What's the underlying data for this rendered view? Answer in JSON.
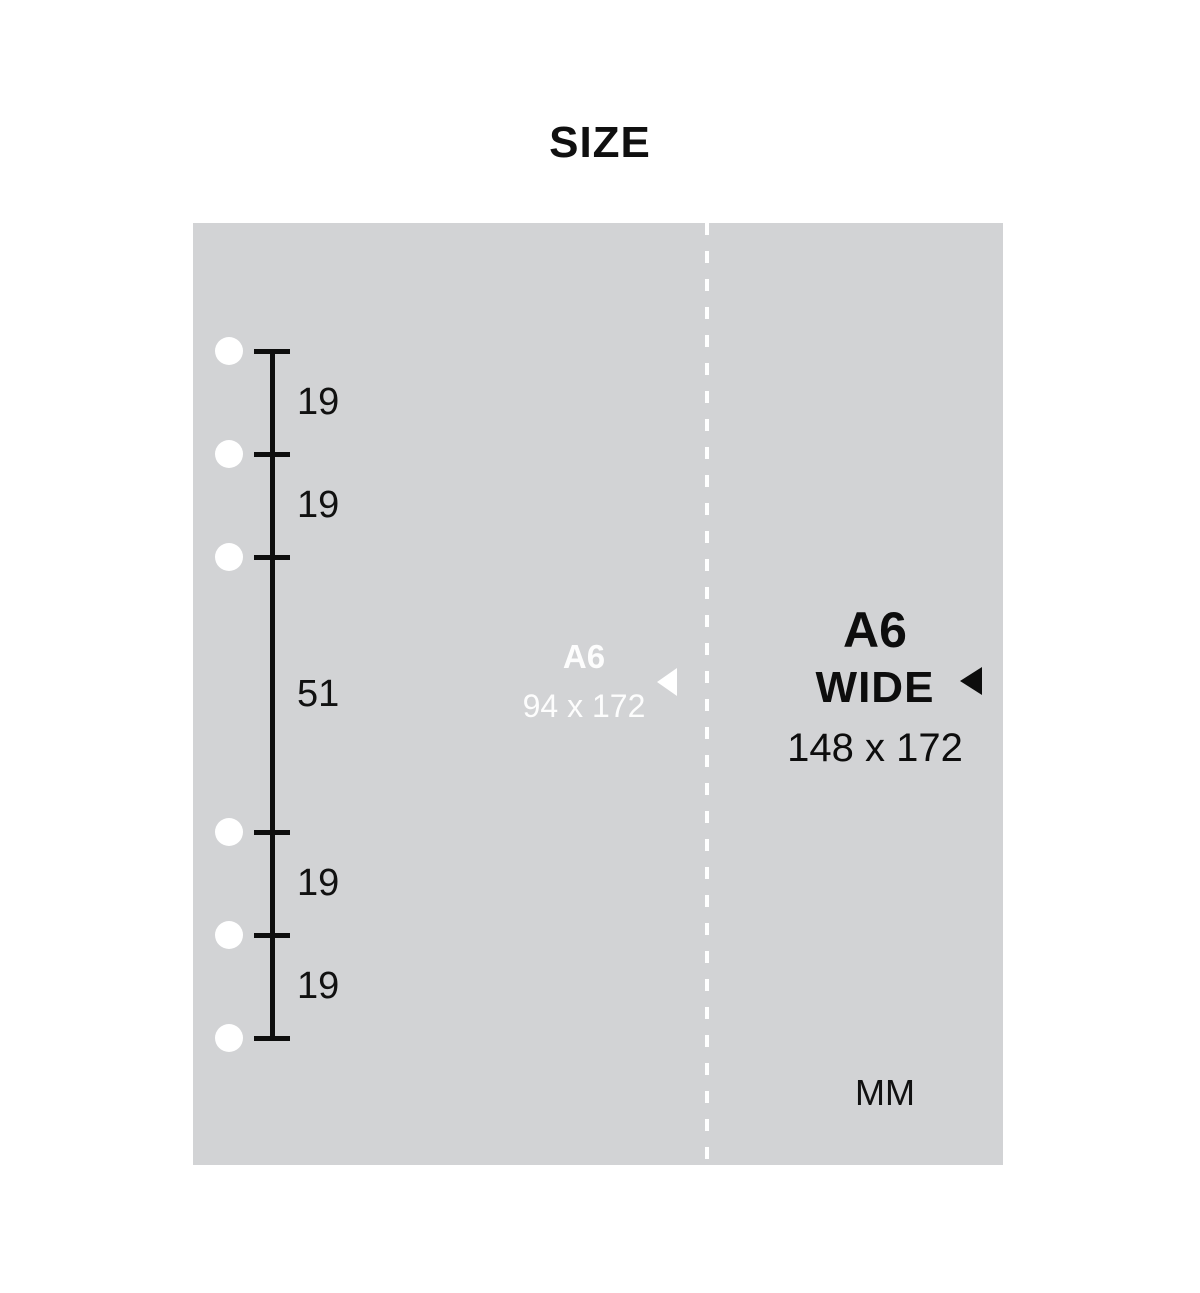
{
  "title": "SIZE",
  "diagram": {
    "ruler_segments": [
      "19",
      "19",
      "51",
      "19",
      "19"
    ],
    "left_page": {
      "label": "A6",
      "dimensions": "94 x 172"
    },
    "right_page": {
      "label": "A6",
      "sublabel": "WIDE",
      "dimensions": "148 x 172"
    },
    "unit": "MM",
    "colors": {
      "page_bg": "#d2d3d5",
      "ink": "#0d0d0d",
      "light_ink": "#ffffff"
    }
  }
}
